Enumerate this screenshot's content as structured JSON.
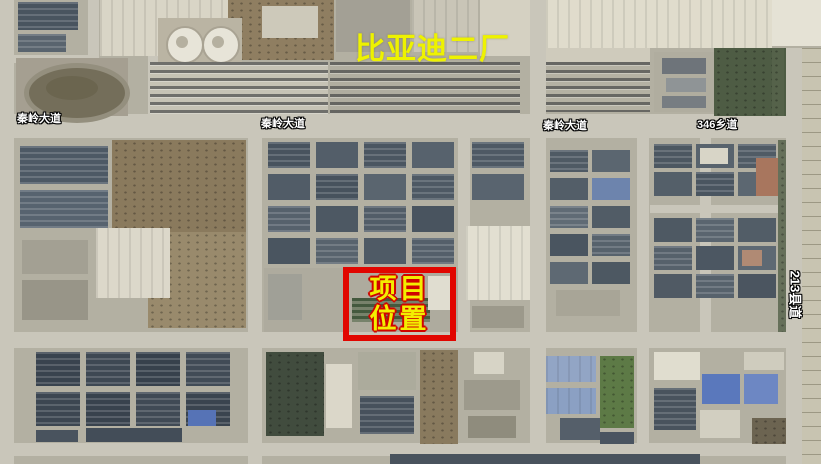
{
  "title": {
    "text": "比亚迪二厂",
    "color": "#eef200"
  },
  "road_labels": [
    {
      "id": "qinling-west",
      "text": "秦岭大道"
    },
    {
      "id": "qinling-center",
      "text": "秦岭大道"
    },
    {
      "id": "qinling-east",
      "text": "秦岭大道"
    },
    {
      "id": "township-346",
      "text": "346乡道"
    },
    {
      "id": "county-213",
      "text": "213县道"
    }
  ],
  "marker": {
    "line1": "项目",
    "line2": "位置",
    "box_color": "#e10600",
    "text_color": "#f3ee00"
  },
  "map": {
    "palette": {
      "base": "#b3b0a2",
      "road": "#c9c6ba",
      "dark_roof": "#49545f",
      "blue_roof": "#5a78bc",
      "dirt": "#8a7a5d",
      "green": "#4e5c44"
    },
    "roads": [
      {
        "x": 0,
        "y": 114,
        "w": 821,
        "h": 24
      },
      {
        "x": 0,
        "y": 332,
        "w": 786,
        "h": 16
      },
      {
        "x": 0,
        "y": 443,
        "w": 821,
        "h": 13
      },
      {
        "x": 0,
        "y": 0,
        "w": 14,
        "h": 464
      },
      {
        "x": 248,
        "y": 138,
        "w": 14,
        "h": 326
      },
      {
        "x": 458,
        "y": 138,
        "w": 12,
        "h": 202
      },
      {
        "x": 530,
        "y": 0,
        "w": 16,
        "h": 464
      },
      {
        "x": 637,
        "y": 138,
        "w": 12,
        "h": 326
      },
      {
        "x": 700,
        "y": 138,
        "w": 11,
        "h": 194
      },
      {
        "x": 650,
        "y": 205,
        "w": 136,
        "h": 8
      },
      {
        "x": 786,
        "y": 48,
        "w": 16,
        "h": 416
      },
      {
        "x": 88,
        "y": 0,
        "w": 11,
        "h": 114
      },
      {
        "x": 148,
        "y": 55,
        "w": 10,
        "h": 59
      },
      {
        "x": 0,
        "y": 55,
        "w": 90,
        "h": 8
      }
    ],
    "shapes": [
      {
        "x": 18,
        "y": 2,
        "w": 60,
        "h": 28,
        "c": "#49545f",
        "t": "panel",
        "n": "building"
      },
      {
        "x": 18,
        "y": 34,
        "w": 48,
        "h": 18,
        "c": "#59646e",
        "t": "panel",
        "n": "building"
      },
      {
        "x": 100,
        "y": 0,
        "w": 130,
        "h": 56,
        "c": "#d9d5c6",
        "t": "ridge",
        "n": "factory-roof"
      },
      {
        "x": 228,
        "y": 0,
        "w": 106,
        "h": 60,
        "c": "#8f7e61",
        "t": "speck",
        "n": "construction-dirt"
      },
      {
        "x": 262,
        "y": 6,
        "w": 56,
        "h": 32,
        "c": "#cdc9ba",
        "n": "building"
      },
      {
        "x": 336,
        "y": 0,
        "w": 74,
        "h": 52,
        "c": "#a3a095",
        "n": "building"
      },
      {
        "x": 412,
        "y": 0,
        "w": 66,
        "h": 52,
        "c": "#c9c5b7",
        "t": "ridge",
        "n": "building"
      },
      {
        "x": 480,
        "y": 0,
        "w": 50,
        "h": 56,
        "c": "#d5d1c2",
        "n": "building"
      },
      {
        "x": 546,
        "y": 0,
        "w": 226,
        "h": 48,
        "c": "#e0dccc",
        "t": "ridge",
        "n": "factory-roof"
      },
      {
        "x": 546,
        "y": 48,
        "w": 104,
        "h": 14,
        "c": "#cfcbbc",
        "n": "apron"
      },
      {
        "x": 714,
        "y": 48,
        "w": 72,
        "h": 68,
        "c": "#4e5c44",
        "t": "speck",
        "n": "green-field"
      },
      {
        "x": 654,
        "y": 52,
        "w": 60,
        "h": 60,
        "c": "#b0ad9f",
        "n": "building"
      },
      {
        "x": 662,
        "y": 58,
        "w": 44,
        "h": 16,
        "c": "#6e747a",
        "n": "building"
      },
      {
        "x": 666,
        "y": 78,
        "w": 40,
        "h": 14,
        "c": "#8f9496",
        "n": "building"
      },
      {
        "x": 662,
        "y": 96,
        "w": 44,
        "h": 12,
        "c": "#777d82",
        "n": "building"
      },
      {
        "x": 772,
        "y": 48,
        "w": 12,
        "h": 68,
        "c": "#55624a",
        "t": "speck",
        "n": "trees"
      },
      {
        "x": 772,
        "y": 0,
        "w": 49,
        "h": 46,
        "c": "#e5e2d5",
        "n": "building"
      },
      {
        "x": 802,
        "y": 48,
        "w": 19,
        "h": 416,
        "c": "#c8c4b1",
        "t": "fieldlines",
        "n": "farm-fields"
      },
      {
        "x": 16,
        "y": 58,
        "w": 112,
        "h": 58,
        "c": "#a59f91",
        "n": "sports-ground"
      },
      {
        "x": 24,
        "y": 63,
        "w": 96,
        "h": 50,
        "c": "#746e5a",
        "r": 1,
        "b": "5px solid #948f7e",
        "n": "running-track"
      },
      {
        "x": 46,
        "y": 76,
        "w": 52,
        "h": 24,
        "c": "#6b654f",
        "r": 1,
        "n": "track-infield"
      },
      {
        "x": 158,
        "y": 18,
        "w": 84,
        "h": 46,
        "c": "#bab4a3",
        "n": "tank-pad"
      },
      {
        "x": 166,
        "y": 26,
        "w": 34,
        "h": 34,
        "c": "#e7e4d8",
        "r": 1,
        "b": "2px solid #a9a393",
        "n": "storage-tank"
      },
      {
        "x": 202,
        "y": 26,
        "w": 34,
        "h": 34,
        "c": "#e7e4d8",
        "r": 1,
        "b": "2px solid #a9a393",
        "n": "storage-tank"
      },
      {
        "x": 176,
        "y": 36,
        "w": 12,
        "h": 12,
        "c": "#b5b0a0",
        "r": 1,
        "n": "tank-top"
      },
      {
        "x": 212,
        "y": 36,
        "w": 12,
        "h": 12,
        "c": "#b5b0a0",
        "r": 1,
        "n": "tank-top"
      },
      {
        "x": 150,
        "y": 62,
        "w": 178,
        "h": 52,
        "c": "#c6c3b5",
        "t": "cars",
        "n": "parking-lot"
      },
      {
        "x": 330,
        "y": 62,
        "w": 190,
        "h": 52,
        "c": "#b0ada0",
        "t": "cars",
        "n": "parking-lot"
      },
      {
        "x": 546,
        "y": 62,
        "w": 104,
        "h": 50,
        "c": "#b4b1a3",
        "t": "cars",
        "n": "truck-yard"
      },
      {
        "x": 112,
        "y": 140,
        "w": 134,
        "h": 92,
        "c": "#8a7a5d",
        "t": "speck",
        "n": "dirt-field"
      },
      {
        "x": 148,
        "y": 232,
        "w": 98,
        "h": 96,
        "c": "#998a6c",
        "t": "speck",
        "n": "dirt-field"
      },
      {
        "x": 20,
        "y": 146,
        "w": 88,
        "h": 38,
        "c": "#4d5965",
        "t": "panel",
        "n": "building"
      },
      {
        "x": 20,
        "y": 190,
        "w": 88,
        "h": 38,
        "c": "#57636f",
        "t": "panel",
        "n": "building"
      },
      {
        "x": 96,
        "y": 228,
        "w": 74,
        "h": 70,
        "c": "#dcd8ca",
        "t": "ridge",
        "n": "warehouse-roof"
      },
      {
        "x": 22,
        "y": 240,
        "w": 66,
        "h": 34,
        "c": "#a3a093",
        "n": "building"
      },
      {
        "x": 22,
        "y": 280,
        "w": 66,
        "h": 40,
        "c": "#989588",
        "n": "building"
      },
      {
        "x": 268,
        "y": 142,
        "w": 42,
        "h": 26,
        "c": "#48535e",
        "t": "panel",
        "n": "building"
      },
      {
        "x": 316,
        "y": 142,
        "w": 42,
        "h": 26,
        "c": "#535e69",
        "n": "building"
      },
      {
        "x": 364,
        "y": 142,
        "w": 42,
        "h": 26,
        "c": "#4b5661",
        "t": "panel",
        "n": "building"
      },
      {
        "x": 412,
        "y": 142,
        "w": 42,
        "h": 26,
        "c": "#57626d",
        "n": "building"
      },
      {
        "x": 268,
        "y": 174,
        "w": 42,
        "h": 26,
        "c": "#515c67",
        "n": "building"
      },
      {
        "x": 316,
        "y": 174,
        "w": 42,
        "h": 26,
        "c": "#47525d",
        "t": "panel",
        "n": "building"
      },
      {
        "x": 364,
        "y": 174,
        "w": 42,
        "h": 26,
        "c": "#5a656f",
        "n": "building"
      },
      {
        "x": 412,
        "y": 174,
        "w": 42,
        "h": 26,
        "c": "#4e5964",
        "t": "panel",
        "n": "building"
      },
      {
        "x": 268,
        "y": 206,
        "w": 42,
        "h": 26,
        "c": "#56616c",
        "t": "panel",
        "n": "building"
      },
      {
        "x": 316,
        "y": 206,
        "w": 42,
        "h": 26,
        "c": "#4d5863",
        "n": "building"
      },
      {
        "x": 364,
        "y": 206,
        "w": 42,
        "h": 26,
        "c": "#525d68",
        "t": "panel",
        "n": "building"
      },
      {
        "x": 412,
        "y": 206,
        "w": 42,
        "h": 26,
        "c": "#49545f",
        "n": "building"
      },
      {
        "x": 268,
        "y": 238,
        "w": 42,
        "h": 26,
        "c": "#4a5560",
        "n": "building"
      },
      {
        "x": 316,
        "y": 238,
        "w": 42,
        "h": 26,
        "c": "#58636d",
        "t": "panel",
        "n": "building"
      },
      {
        "x": 364,
        "y": 238,
        "w": 42,
        "h": 26,
        "c": "#4f5a65",
        "n": "building"
      },
      {
        "x": 412,
        "y": 238,
        "w": 42,
        "h": 26,
        "c": "#545f6a",
        "t": "panel",
        "n": "building"
      },
      {
        "x": 264,
        "y": 268,
        "w": 194,
        "h": 64,
        "c": "#aeab9e",
        "n": "project-site-ground"
      },
      {
        "x": 268,
        "y": 274,
        "w": 34,
        "h": 46,
        "c": "#a0a097",
        "n": "building"
      },
      {
        "x": 352,
        "y": 298,
        "w": 78,
        "h": 24,
        "c": "#77826b",
        "t": "grows",
        "n": "canopy-rows"
      },
      {
        "x": 428,
        "y": 276,
        "w": 26,
        "h": 34,
        "c": "#e0ddd0",
        "n": "building"
      },
      {
        "x": 472,
        "y": 142,
        "w": 52,
        "h": 26,
        "c": "#4e5964",
        "t": "panel",
        "n": "building"
      },
      {
        "x": 472,
        "y": 174,
        "w": 52,
        "h": 26,
        "c": "#59646f",
        "n": "building"
      },
      {
        "x": 466,
        "y": 226,
        "w": 64,
        "h": 74,
        "c": "#e2dfd1",
        "t": "ridge",
        "n": "warehouse-roof"
      },
      {
        "x": 472,
        "y": 306,
        "w": 52,
        "h": 22,
        "c": "#9c998b",
        "n": "building"
      },
      {
        "x": 550,
        "y": 150,
        "w": 38,
        "h": 22,
        "c": "#4f5a64",
        "t": "panel",
        "n": "building"
      },
      {
        "x": 592,
        "y": 150,
        "w": 38,
        "h": 22,
        "c": "#5b6670",
        "n": "building"
      },
      {
        "x": 550,
        "y": 178,
        "w": 38,
        "h": 22,
        "c": "#535e68",
        "n": "building"
      },
      {
        "x": 592,
        "y": 178,
        "w": 38,
        "h": 22,
        "c": "#6d84ad",
        "n": "building"
      },
      {
        "x": 550,
        "y": 206,
        "w": 38,
        "h": 22,
        "c": "#606b75",
        "t": "panel",
        "n": "building"
      },
      {
        "x": 592,
        "y": 206,
        "w": 38,
        "h": 22,
        "c": "#515c66",
        "n": "building"
      },
      {
        "x": 550,
        "y": 234,
        "w": 38,
        "h": 22,
        "c": "#4a5560",
        "n": "building"
      },
      {
        "x": 592,
        "y": 234,
        "w": 38,
        "h": 22,
        "c": "#57626c",
        "t": "panel",
        "n": "building"
      },
      {
        "x": 550,
        "y": 262,
        "w": 38,
        "h": 22,
        "c": "#5e6973",
        "n": "building"
      },
      {
        "x": 592,
        "y": 262,
        "w": 38,
        "h": 22,
        "c": "#4d5862",
        "n": "building"
      },
      {
        "x": 556,
        "y": 290,
        "w": 64,
        "h": 26,
        "c": "#a8a597",
        "n": "building"
      },
      {
        "x": 654,
        "y": 144,
        "w": 38,
        "h": 24,
        "c": "#4c5761",
        "t": "panel",
        "n": "building"
      },
      {
        "x": 696,
        "y": 144,
        "w": 38,
        "h": 24,
        "c": "#58636d",
        "n": "building"
      },
      {
        "x": 738,
        "y": 144,
        "w": 38,
        "h": 24,
        "c": "#505b65",
        "t": "panel",
        "n": "building"
      },
      {
        "x": 654,
        "y": 172,
        "w": 38,
        "h": 24,
        "c": "#545f69",
        "n": "building"
      },
      {
        "x": 696,
        "y": 172,
        "w": 38,
        "h": 24,
        "c": "#4a5560",
        "t": "panel",
        "n": "building"
      },
      {
        "x": 738,
        "y": 172,
        "w": 38,
        "h": 24,
        "c": "#5c6771",
        "n": "building"
      },
      {
        "x": 756,
        "y": 158,
        "w": 24,
        "h": 38,
        "c": "#a8765e",
        "n": "red-roof-building"
      },
      {
        "x": 700,
        "y": 148,
        "w": 28,
        "h": 16,
        "c": "#d8d5c7",
        "n": "building"
      },
      {
        "x": 654,
        "y": 218,
        "w": 38,
        "h": 24,
        "c": "#4e5963",
        "n": "building"
      },
      {
        "x": 696,
        "y": 218,
        "w": 38,
        "h": 24,
        "c": "#5a656f",
        "t": "panel",
        "n": "building"
      },
      {
        "x": 738,
        "y": 218,
        "w": 38,
        "h": 24,
        "c": "#525d67",
        "n": "building"
      },
      {
        "x": 654,
        "y": 246,
        "w": 38,
        "h": 24,
        "c": "#56616b",
        "t": "panel",
        "n": "building"
      },
      {
        "x": 696,
        "y": 246,
        "w": 38,
        "h": 24,
        "c": "#4c5762",
        "n": "building"
      },
      {
        "x": 738,
        "y": 246,
        "w": 38,
        "h": 24,
        "c": "#5e6973",
        "n": "building"
      },
      {
        "x": 742,
        "y": 250,
        "w": 20,
        "h": 16,
        "c": "#b08a74",
        "n": "red-roof-building"
      },
      {
        "x": 654,
        "y": 274,
        "w": 38,
        "h": 24,
        "c": "#505a64",
        "n": "building"
      },
      {
        "x": 696,
        "y": 274,
        "w": 38,
        "h": 24,
        "c": "#57626c",
        "t": "panel",
        "n": "building"
      },
      {
        "x": 738,
        "y": 274,
        "w": 38,
        "h": 24,
        "c": "#4b5560",
        "n": "building"
      },
      {
        "x": 778,
        "y": 140,
        "w": 8,
        "h": 192,
        "c": "#66705a",
        "t": "speck",
        "n": "trees"
      },
      {
        "x": 36,
        "y": 352,
        "w": 44,
        "h": 34,
        "c": "#39434e",
        "t": "panel",
        "n": "solar-roof"
      },
      {
        "x": 86,
        "y": 352,
        "w": 44,
        "h": 34,
        "c": "#3e4853",
        "t": "panel",
        "n": "solar-roof"
      },
      {
        "x": 136,
        "y": 352,
        "w": 44,
        "h": 34,
        "c": "#37414c",
        "t": "panel",
        "n": "solar-roof"
      },
      {
        "x": 186,
        "y": 352,
        "w": 44,
        "h": 34,
        "c": "#414b56",
        "t": "panel",
        "n": "solar-roof"
      },
      {
        "x": 36,
        "y": 392,
        "w": 44,
        "h": 34,
        "c": "#3c4651",
        "t": "panel",
        "n": "solar-roof"
      },
      {
        "x": 86,
        "y": 392,
        "w": 44,
        "h": 34,
        "c": "#38424d",
        "t": "panel",
        "n": "solar-roof"
      },
      {
        "x": 136,
        "y": 392,
        "w": 44,
        "h": 34,
        "c": "#404a55",
        "t": "panel",
        "n": "solar-roof"
      },
      {
        "x": 186,
        "y": 392,
        "w": 44,
        "h": 34,
        "c": "#3a444f",
        "t": "panel",
        "n": "solar-roof"
      },
      {
        "x": 86,
        "y": 428,
        "w": 96,
        "h": 14,
        "c": "#434d58",
        "n": "building"
      },
      {
        "x": 188,
        "y": 410,
        "w": 28,
        "h": 16,
        "c": "#5673b6",
        "n": "blue-roof"
      },
      {
        "x": 36,
        "y": 430,
        "w": 42,
        "h": 12,
        "c": "#49535e",
        "n": "building"
      },
      {
        "x": 266,
        "y": 352,
        "w": 58,
        "h": 84,
        "c": "#414c3e",
        "t": "speck",
        "n": "pond"
      },
      {
        "x": 326,
        "y": 364,
        "w": 26,
        "h": 64,
        "c": "#dbd7c9",
        "n": "building"
      },
      {
        "x": 358,
        "y": 352,
        "w": 58,
        "h": 38,
        "c": "#acab9c",
        "n": "building"
      },
      {
        "x": 360,
        "y": 396,
        "w": 54,
        "h": 38,
        "c": "#47515c",
        "t": "panel",
        "n": "building"
      },
      {
        "x": 420,
        "y": 350,
        "w": 38,
        "h": 94,
        "c": "#897a5e",
        "t": "speck",
        "n": "dirt-field"
      },
      {
        "x": 474,
        "y": 352,
        "w": 30,
        "h": 22,
        "c": "#d7d4c6",
        "n": "building"
      },
      {
        "x": 464,
        "y": 380,
        "w": 56,
        "h": 30,
        "c": "#9d9a8c",
        "n": "building"
      },
      {
        "x": 468,
        "y": 416,
        "w": 48,
        "h": 22,
        "c": "#8f8c7d",
        "n": "building"
      },
      {
        "x": 546,
        "y": 356,
        "w": 50,
        "h": 26,
        "c": "#92a5c5",
        "t": "ridge",
        "n": "blue-roof"
      },
      {
        "x": 546,
        "y": 388,
        "w": 50,
        "h": 26,
        "c": "#8ba0c3",
        "t": "ridge",
        "n": "blue-roof"
      },
      {
        "x": 600,
        "y": 356,
        "w": 34,
        "h": 72,
        "c": "#5d7a46",
        "t": "speck",
        "n": "green-field"
      },
      {
        "x": 560,
        "y": 418,
        "w": 40,
        "h": 22,
        "c": "#555f6a",
        "n": "building"
      },
      {
        "x": 600,
        "y": 432,
        "w": 34,
        "h": 12,
        "c": "#4a5460",
        "n": "building"
      },
      {
        "x": 654,
        "y": 352,
        "w": 46,
        "h": 28,
        "c": "#e0ddcf",
        "n": "building"
      },
      {
        "x": 744,
        "y": 352,
        "w": 40,
        "h": 18,
        "c": "#cfccbe",
        "n": "building"
      },
      {
        "x": 702,
        "y": 374,
        "w": 38,
        "h": 30,
        "c": "#5a78bc",
        "n": "blue-roof"
      },
      {
        "x": 744,
        "y": 374,
        "w": 34,
        "h": 30,
        "c": "#6d87c3",
        "n": "blue-roof"
      },
      {
        "x": 654,
        "y": 388,
        "w": 42,
        "h": 42,
        "c": "#49535d",
        "t": "panel",
        "n": "building"
      },
      {
        "x": 700,
        "y": 410,
        "w": 40,
        "h": 28,
        "c": "#d2cfc1",
        "n": "building"
      },
      {
        "x": 752,
        "y": 418,
        "w": 34,
        "h": 26,
        "c": "#6c6451",
        "t": "speck",
        "n": "dirt-field"
      },
      {
        "x": 390,
        "y": 454,
        "w": 310,
        "h": 10,
        "c": "#49535d",
        "n": "building"
      }
    ]
  }
}
